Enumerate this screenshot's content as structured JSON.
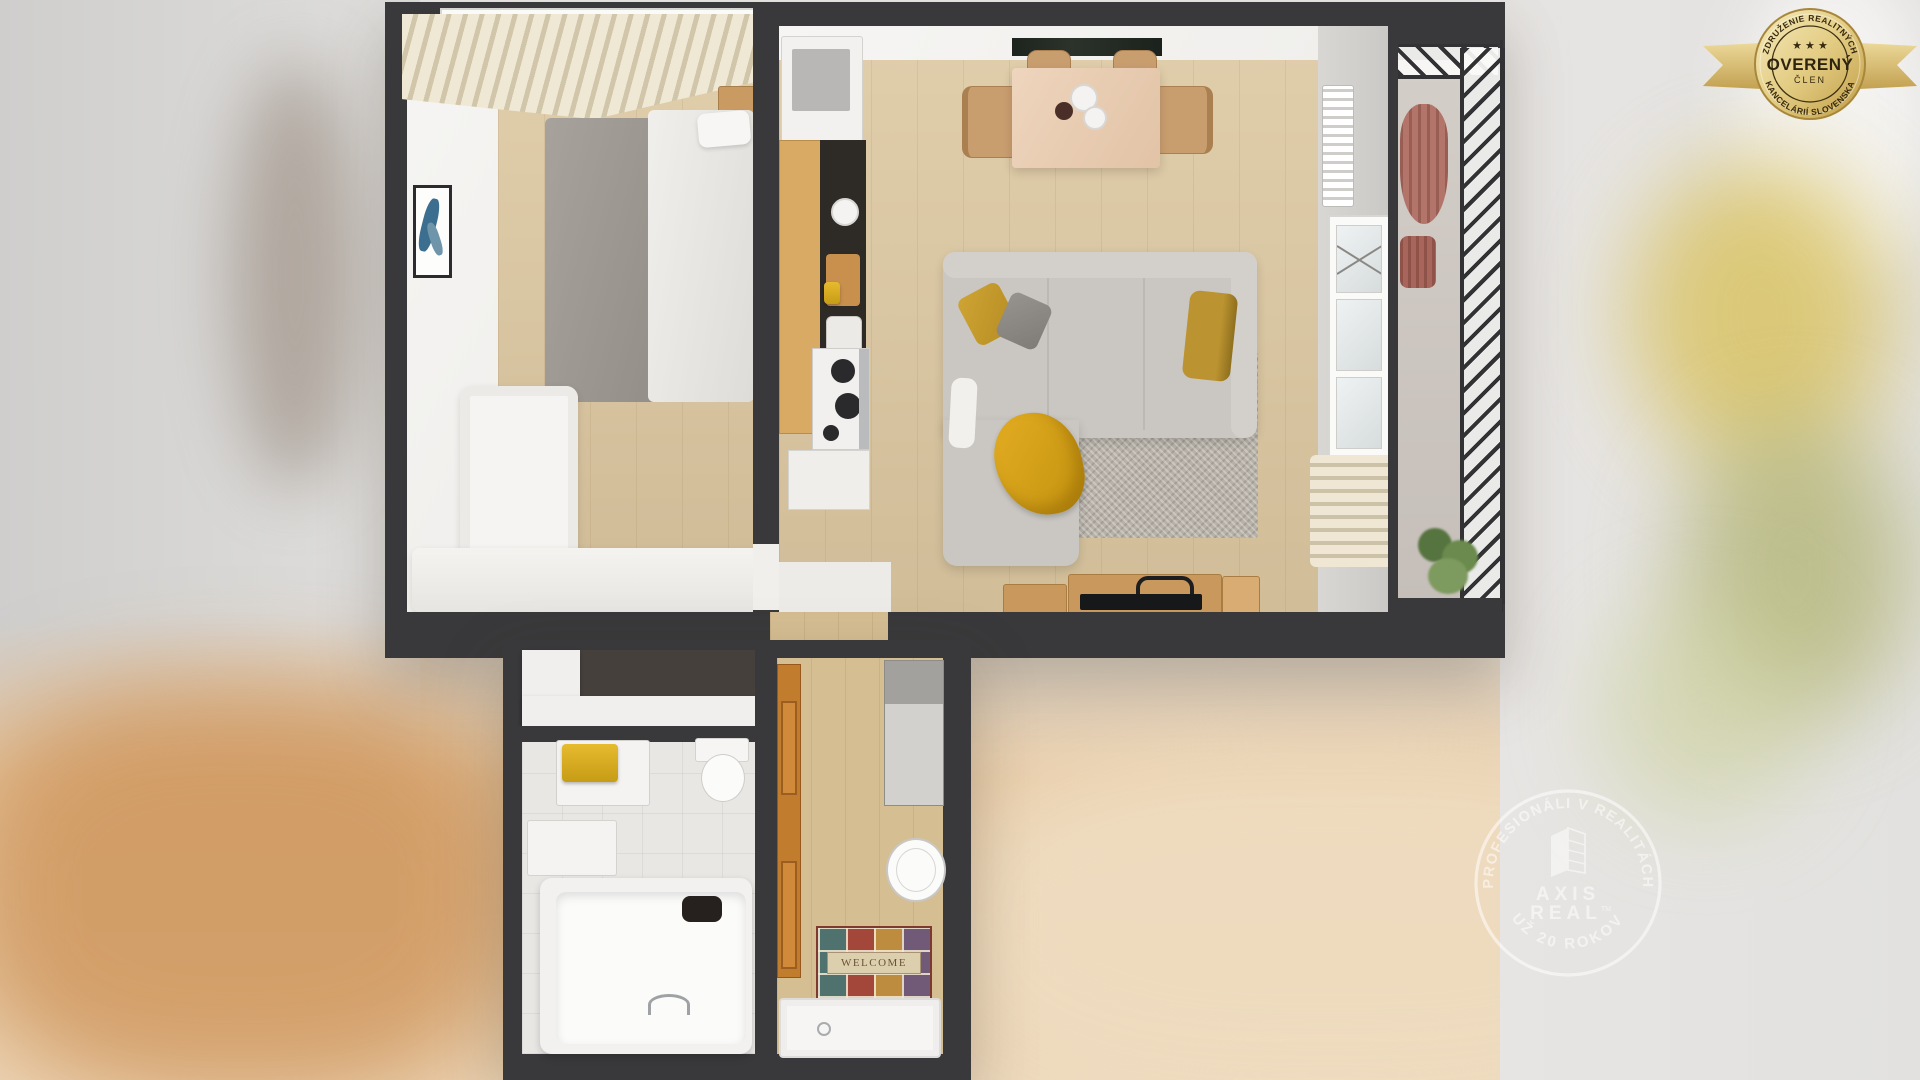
{
  "badge": {
    "arc_top": "ZDRUŽENIE REALITNÝCH",
    "stars": "★ ★ ★",
    "title": "OVERENÝ",
    "subtitle": "ČLEN",
    "arc_bottom": "KANCELÁRIÍ SLOVENSKA",
    "colors": {
      "gold_light": "#f6ebbd",
      "gold_dark": "#c29d47",
      "text": "#35290f"
    }
  },
  "watermark": {
    "arc_top": "PROFESIONÁLI V REALITÁCH",
    "brand_line1": "AXIS",
    "brand_line2": "REAL",
    "tm": "TM",
    "arc_bottom": "UŽ 20 ROKOV",
    "color": "#ffffff",
    "opacity": "0.55"
  },
  "floorplan": {
    "doormat_text": "WELCOME",
    "colors": {
      "wall": "#39393b",
      "wood_floor": "#dcc7a0",
      "hall_floor": "#d6be93",
      "white_wall": "#f3f2f0",
      "sofa_gray": "#cac7c2",
      "accent_yellow": "#d9a725",
      "rug_gray": "#b7b1a8",
      "kitchen_wood": "#d9aa63",
      "counter_dark": "#2e2b27",
      "balcony_rail": "#323234",
      "plant_green": "#5d7a45"
    }
  }
}
